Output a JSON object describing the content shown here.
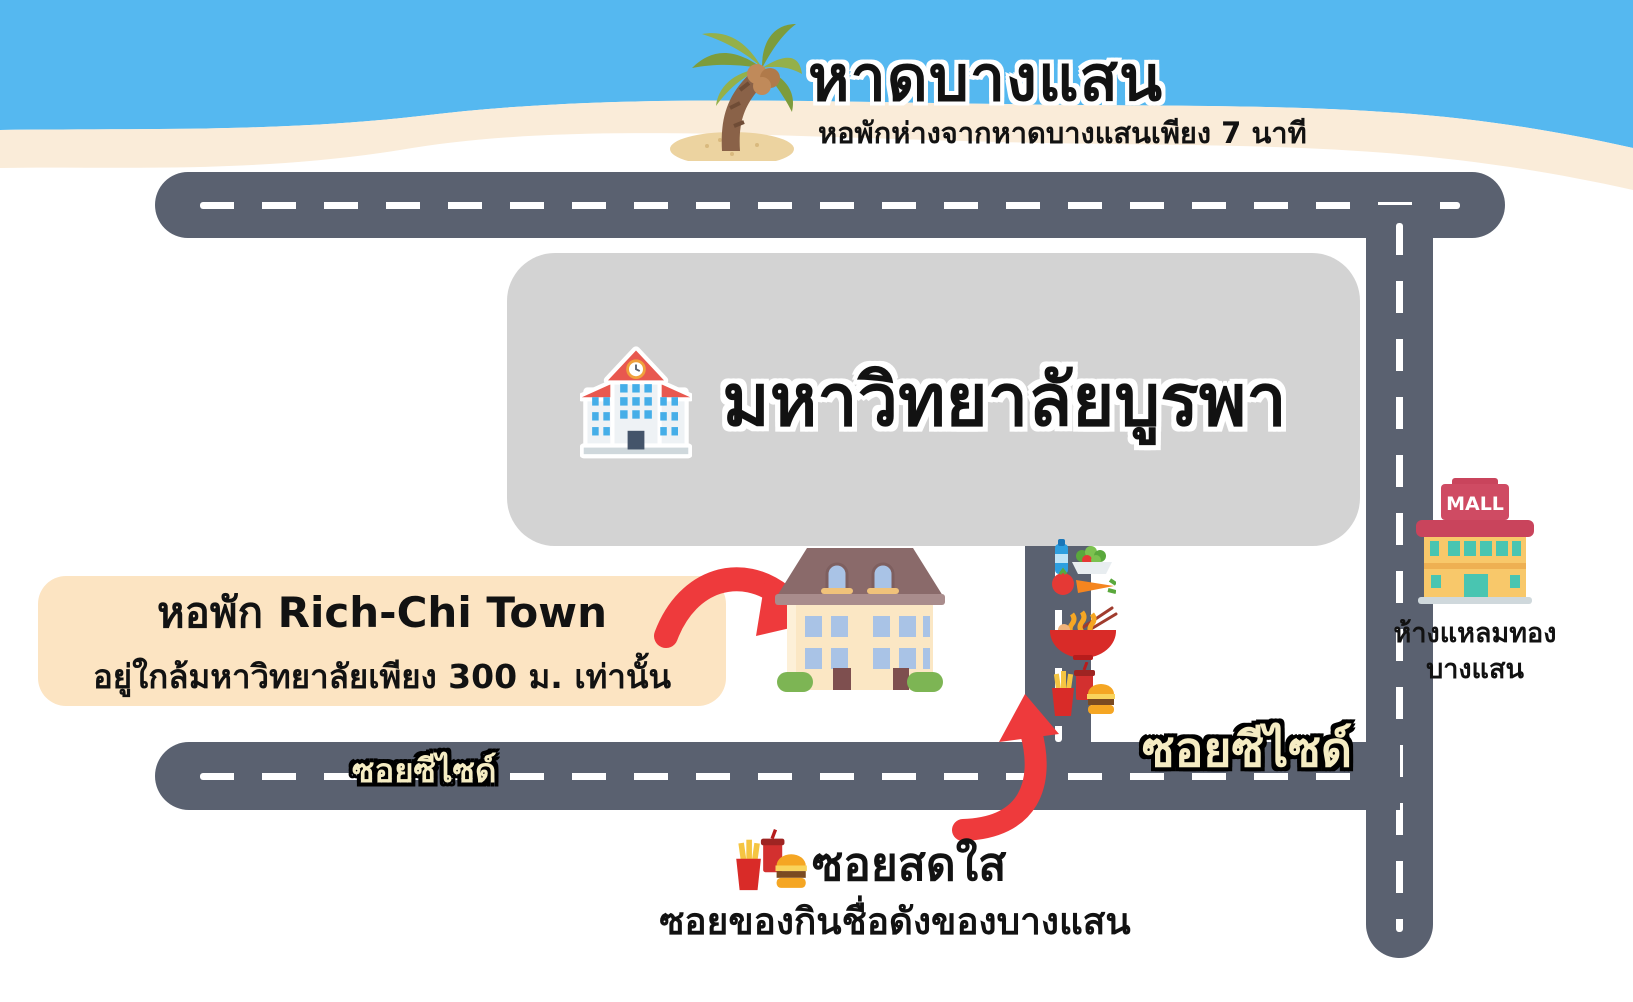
{
  "header": {
    "title": "หาดบางแสน",
    "subtitle": "หอพักห่างจากหาดบางแสนเพียง 7 นาที",
    "sky_color": "#55b8f0",
    "sand_color": "#faecd9",
    "palm_icon": "palm-tree-icon"
  },
  "university": {
    "name": "มหาวิทยาลัยบูรพา",
    "icon": "university-building-icon",
    "block_color": "#d3d3d3"
  },
  "dorm_callout": {
    "line1": "หอพัก Rich-Chi Town",
    "line2": "อยู่ใกล้มหาวิทยาลัยเพียง 300 ม. เท่านั้น",
    "box_color": "#fce4c2",
    "building_icon": "dorm-building-icon"
  },
  "roads": {
    "color": "#5a6170",
    "label_color": "#f5ecc3",
    "label_seaside_left": "ซอยซีไซด์",
    "label_seaside_right": "ซอยซีไซด์"
  },
  "soi_sodsai": {
    "name": "ซอยสดใส",
    "description": "ซอยของกินชื่อดังของบางแสน",
    "icon": "fastfood-icon"
  },
  "food_stalls": {
    "icons": [
      "healthy-food-icon",
      "noodle-bowl-icon",
      "fastfood-icon"
    ]
  },
  "mall": {
    "sign": "MALL",
    "name_line1": "ห้างแหลมทอง",
    "name_line2": "บางแสน",
    "icon": "mall-icon"
  },
  "accents": {
    "arrow_color": "#ee3a3c"
  }
}
